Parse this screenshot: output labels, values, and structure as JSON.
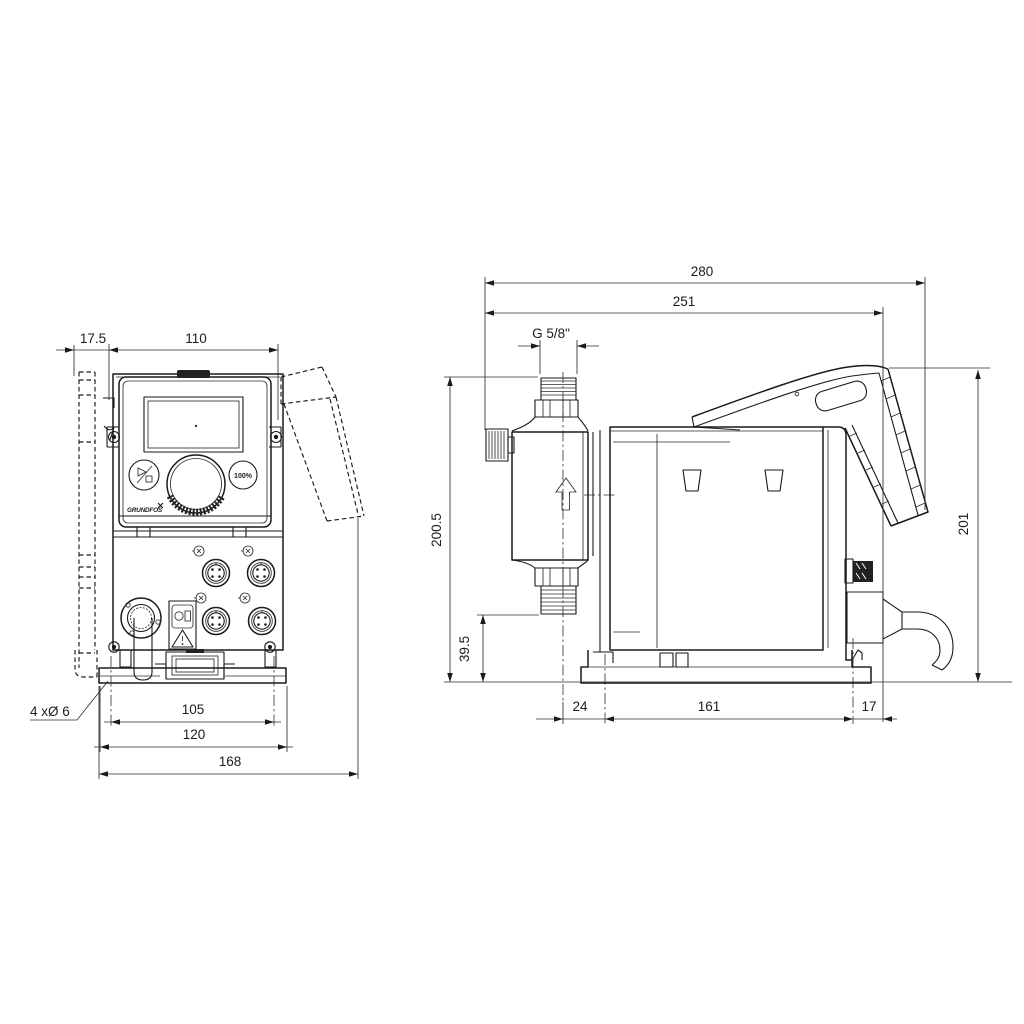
{
  "colors": {
    "background": "#ffffff",
    "line": "#1a1a1a",
    "text": "#1b1c20"
  },
  "front_view": {
    "dims": {
      "bracket_offset": "17.5",
      "body_width": "110",
      "mounting_hole_spacing": "105",
      "plate_width": "120",
      "overall_width": "168",
      "holes_note": "4 xØ 6"
    },
    "panel": {
      "capacity_button_label": "100%",
      "brand_logo": "GRUNDFOS"
    }
  },
  "side_view": {
    "dims": {
      "overall_depth": "280",
      "depth_to_housing_rear": "251",
      "connection_thread": "G 5/8\"",
      "height_to_connection": "200.5",
      "height_to_valve": "39.5",
      "head_center_to_first_hole": "24",
      "hole_spacing": "161",
      "rear_hole_to_gland": "17",
      "overall_height": "201"
    }
  }
}
